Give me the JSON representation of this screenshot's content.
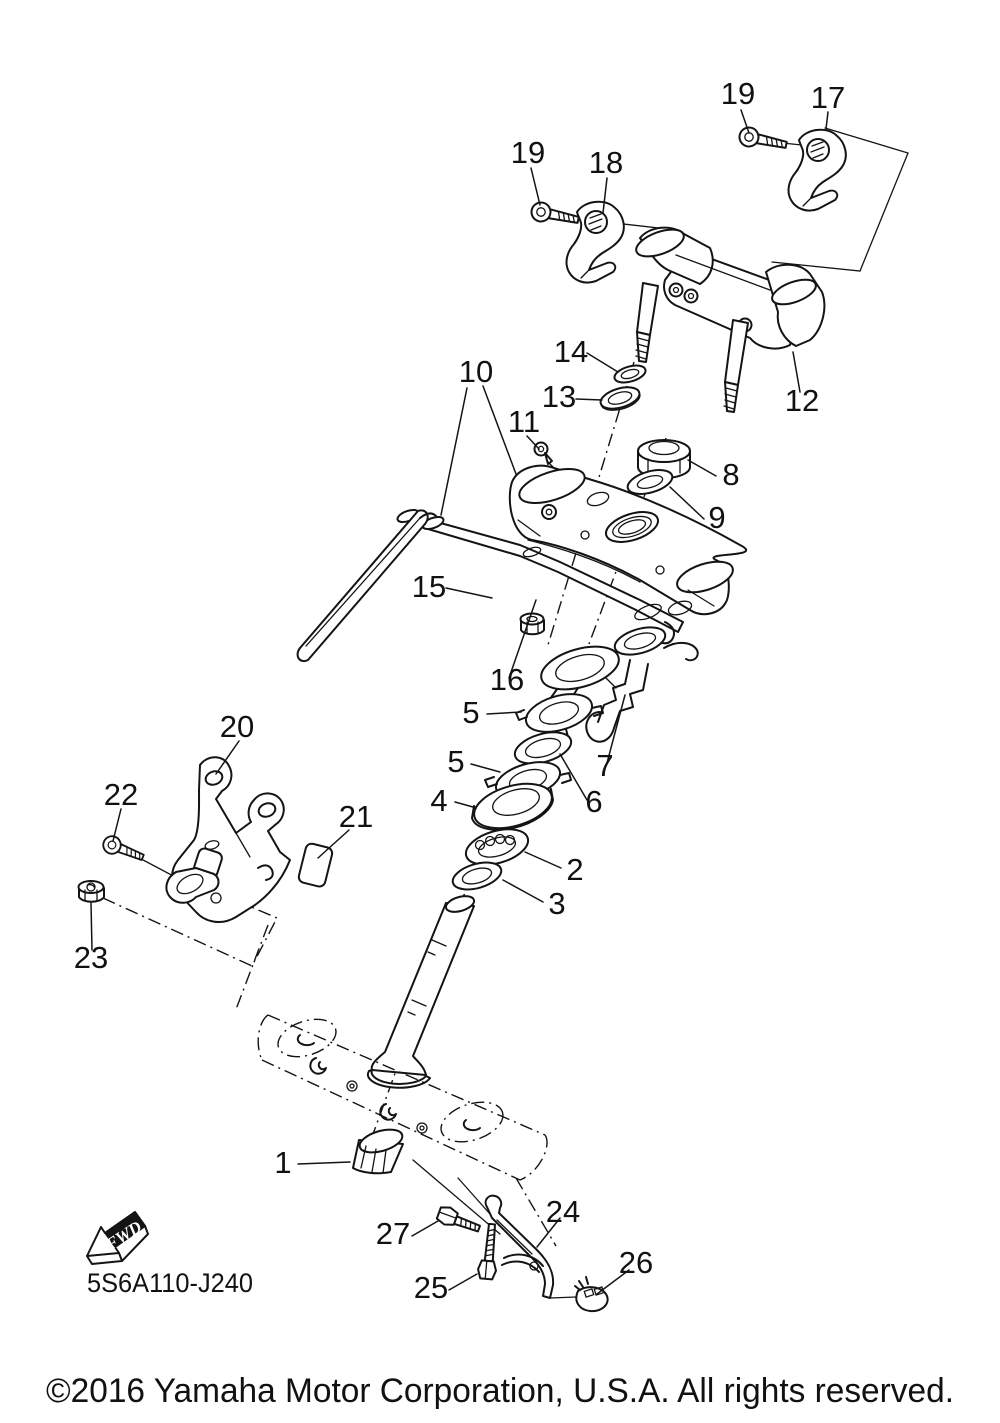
{
  "diagram": {
    "title_code": "5S6A110-J240",
    "fwd_label": "FWD",
    "footer": {
      "copyright": "©2016 Yamaha Motor Corporation, U.S.A. All rights reserved."
    },
    "line_color": "#141414",
    "background_color": "#ffffff",
    "callouts": [
      {
        "id": "19-top",
        "label": "19"
      },
      {
        "id": "17",
        "label": "17"
      },
      {
        "id": "19-left",
        "label": "19"
      },
      {
        "id": "18",
        "label": "18"
      },
      {
        "id": "14",
        "label": "14"
      },
      {
        "id": "13",
        "label": "13"
      },
      {
        "id": "12",
        "label": "12"
      },
      {
        "id": "10",
        "label": "10"
      },
      {
        "id": "11",
        "label": "11"
      },
      {
        "id": "8",
        "label": "8"
      },
      {
        "id": "9",
        "label": "9"
      },
      {
        "id": "15",
        "label": "15"
      },
      {
        "id": "16",
        "label": "16"
      },
      {
        "id": "5-upper",
        "label": "5"
      },
      {
        "id": "7",
        "label": "7"
      },
      {
        "id": "5-lower",
        "label": "5"
      },
      {
        "id": "6",
        "label": "6"
      },
      {
        "id": "4",
        "label": "4"
      },
      {
        "id": "2",
        "label": "2"
      },
      {
        "id": "3",
        "label": "3"
      },
      {
        "id": "20",
        "label": "20"
      },
      {
        "id": "22",
        "label": "22"
      },
      {
        "id": "21",
        "label": "21"
      },
      {
        "id": "23",
        "label": "23"
      },
      {
        "id": "1",
        "label": "1"
      },
      {
        "id": "27",
        "label": "27"
      },
      {
        "id": "25",
        "label": "25"
      },
      {
        "id": "24",
        "label": "24"
      },
      {
        "id": "26",
        "label": "26"
      }
    ]
  }
}
